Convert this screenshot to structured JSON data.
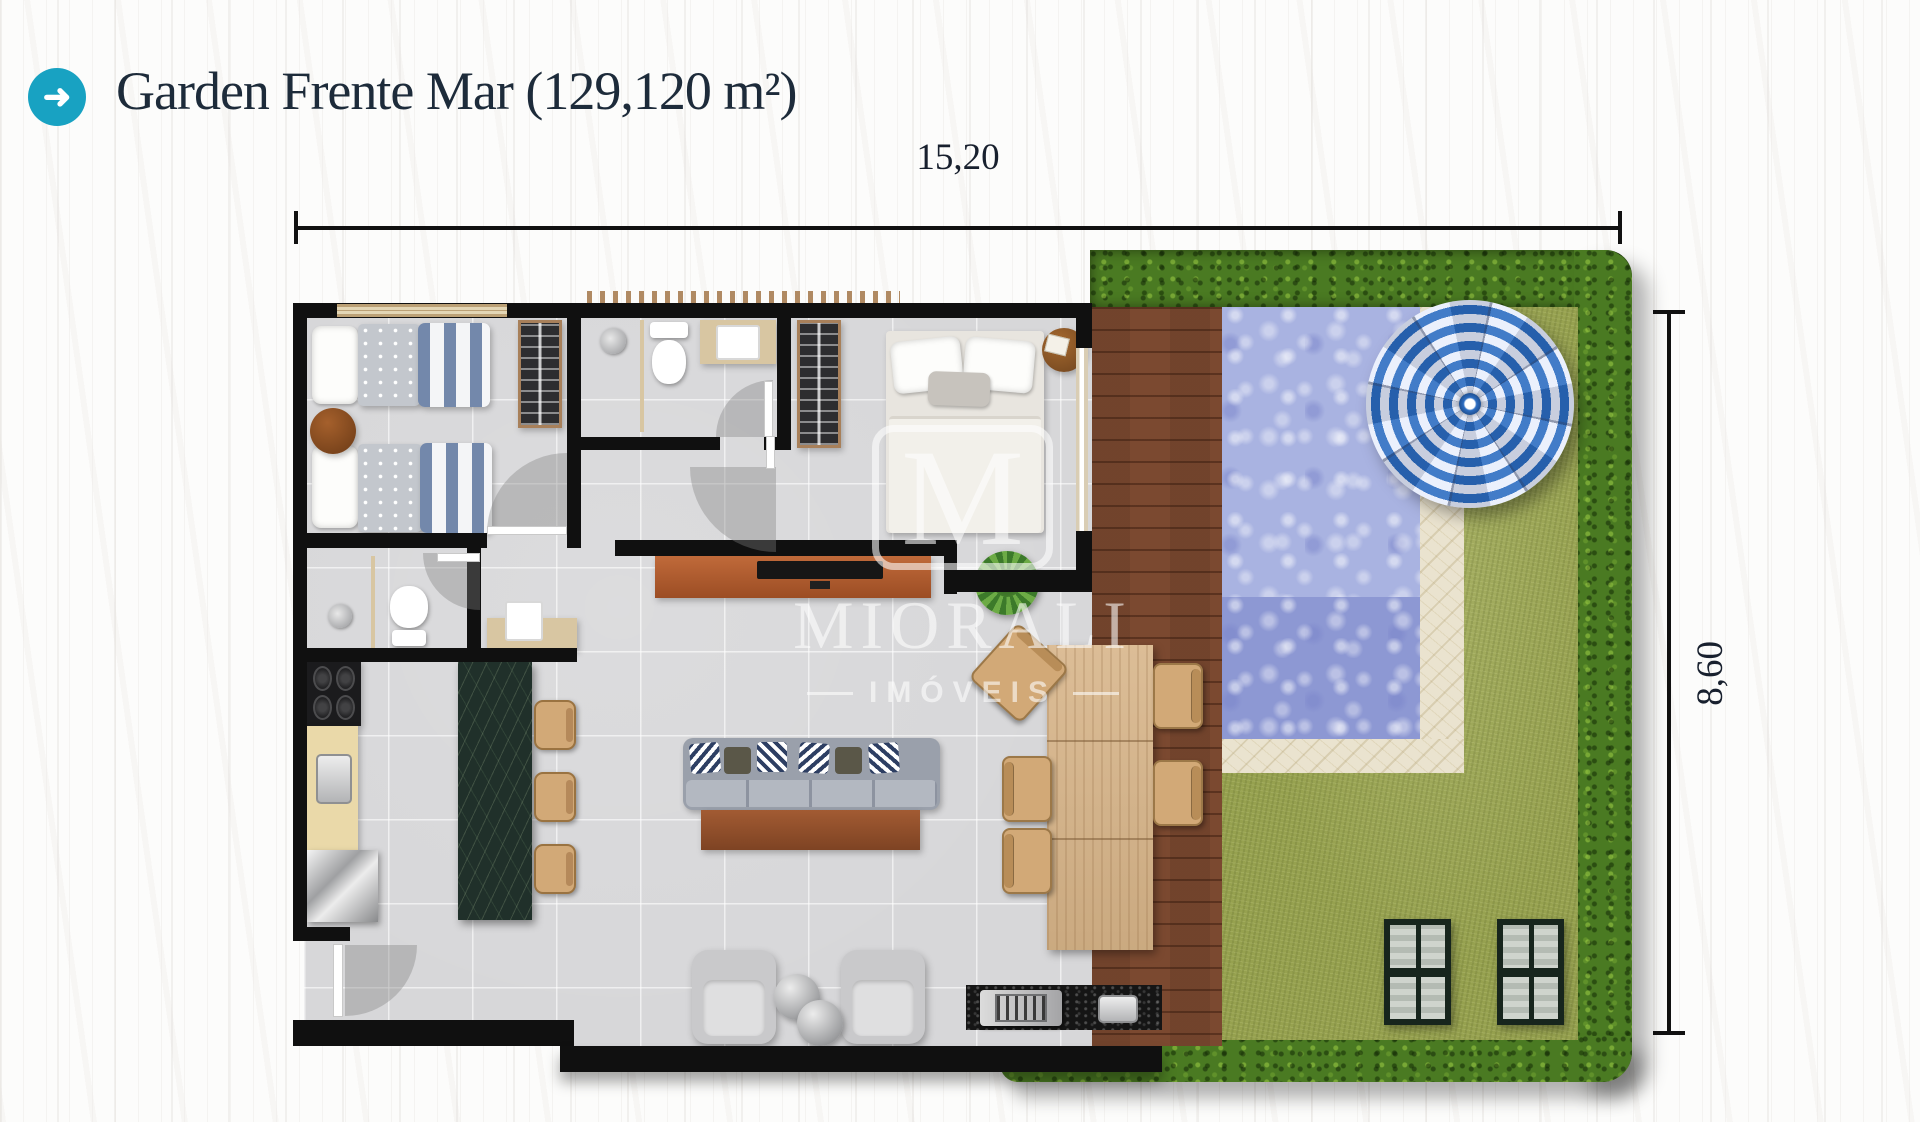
{
  "header": {
    "icon_glyph": "➜",
    "title": "Garden Frente Mar (129,120 m²)"
  },
  "dimensions": {
    "width_label": "15,20",
    "height_label": "8,60"
  },
  "watermark": {
    "logo_letter": "M",
    "name": "MIORALI",
    "subtitle": "IMÓVEIS"
  },
  "palette": {
    "accent_teal": "#18A2C2",
    "title_navy": "#1D2B3A",
    "dimension_text": "#18202E",
    "wall_black": "#101010",
    "floor_tile_gray": "#D7D7D9",
    "deck_brown": "#7B4930",
    "pool_blue": "#A9B3E1",
    "pool_deep_blue": "#8D98D3",
    "marble_beige": "#EAE3CF",
    "grass_olive": "#96A14F",
    "hedge_green": "#4A7A22",
    "island_marble_green": "#20302A",
    "counter_tan": "#D8C6A2",
    "umbrella_blue": "#2D6EC2",
    "watermark_white": "#FFFFFF"
  }
}
